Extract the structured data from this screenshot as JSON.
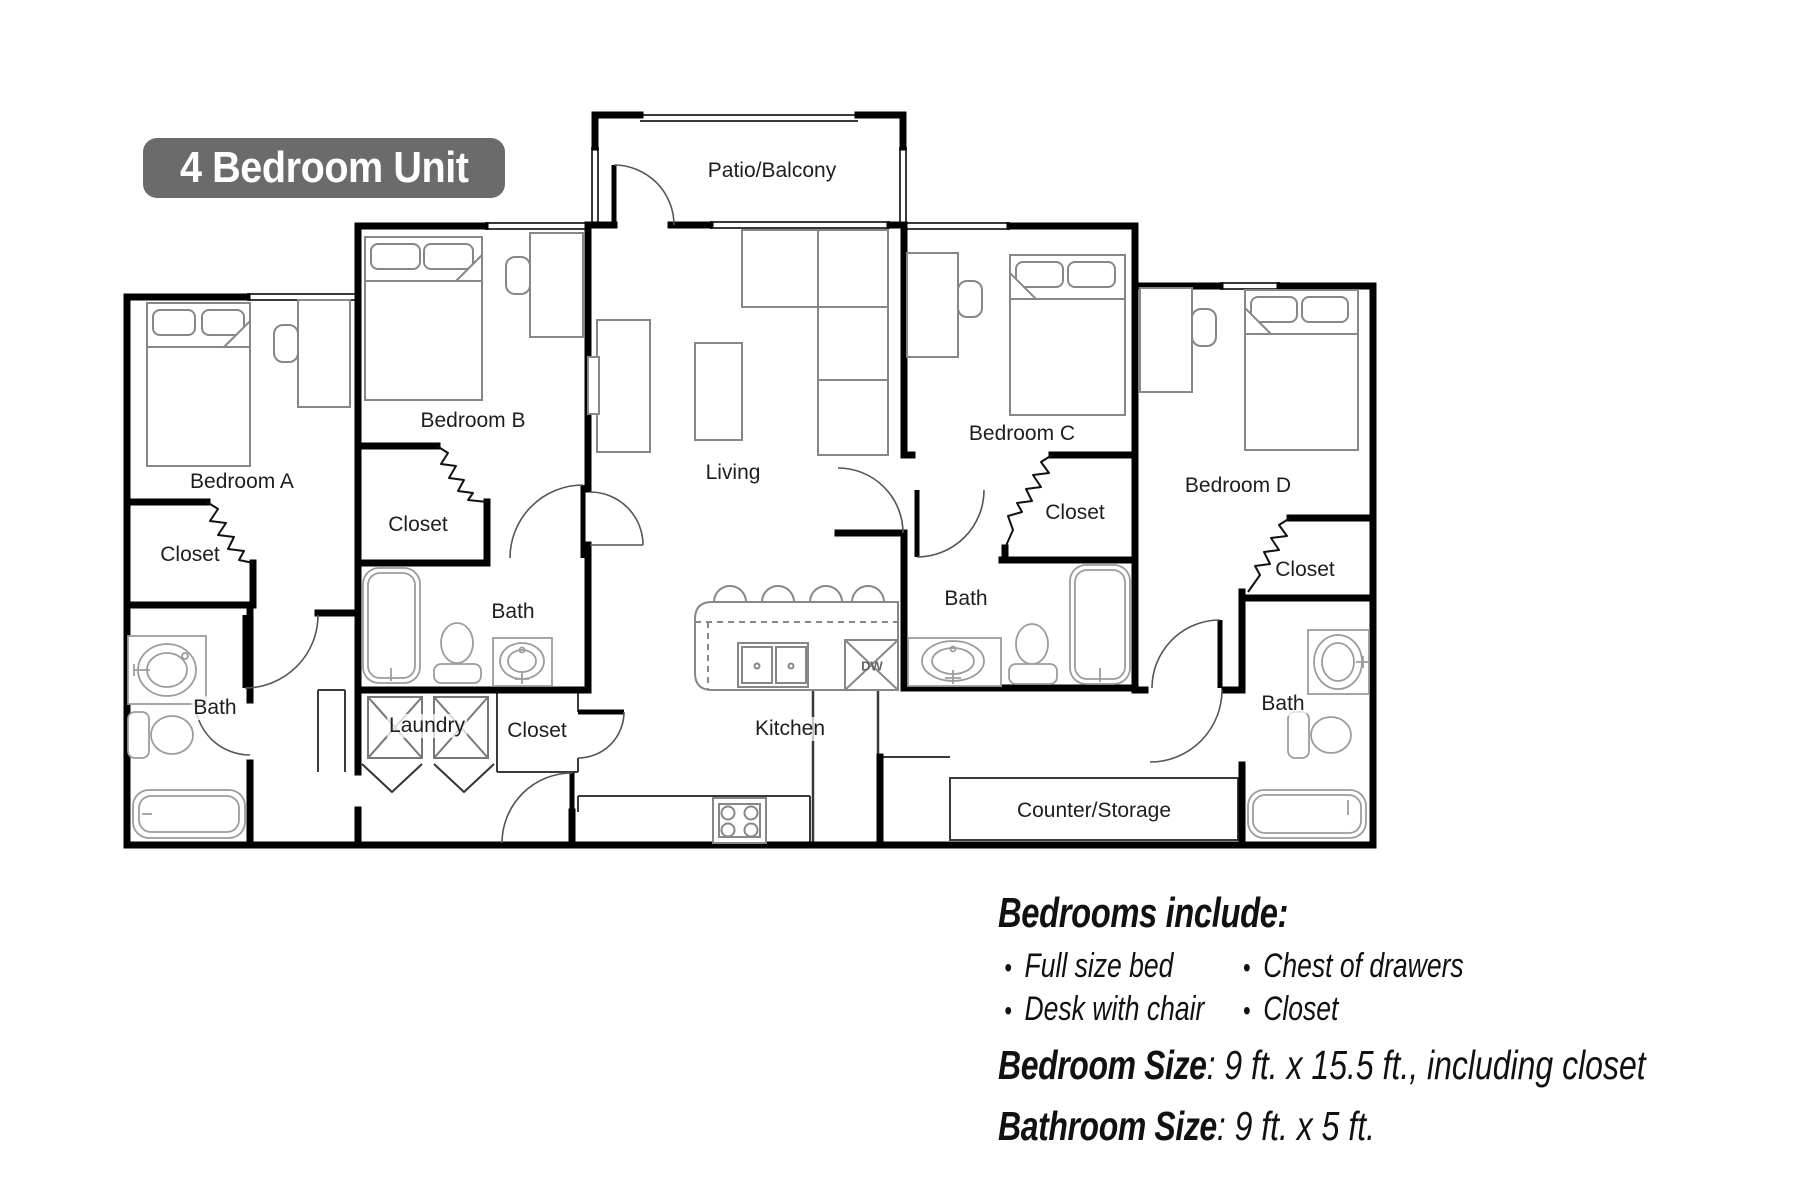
{
  "title": "4 Bedroom Unit",
  "floorplan": {
    "labels": {
      "patio": "Patio/Balcony",
      "living": "Living",
      "kitchen": "Kitchen",
      "bedroom_a": "Bedroom A",
      "bedroom_b": "Bedroom B",
      "bedroom_c": "Bedroom C",
      "bedroom_d": "Bedroom D",
      "closet": "Closet",
      "bath": "Bath",
      "laundry": "Laundry",
      "counter_storage": "Counter/Storage",
      "dishwasher": "DW"
    }
  },
  "details": {
    "heading": "Bedrooms include:",
    "bullets_col1": [
      "Full size bed",
      "Desk with chair"
    ],
    "bullets_col2": [
      "Chest of drawers",
      "Closet"
    ],
    "bedroom_size_label": "Bedroom Size",
    "bedroom_size_value": ": 9 ft. x 15.5 ft., including closet",
    "bathroom_size_label": "Bathroom Size",
    "bathroom_size_value": ": 9 ft. x 5 ft."
  },
  "colors": {
    "title_bg": "#6b6b6b",
    "title_text": "#ffffff",
    "wall": "#000000",
    "furniture": "#888888",
    "fixture": "#9c9c9c"
  }
}
